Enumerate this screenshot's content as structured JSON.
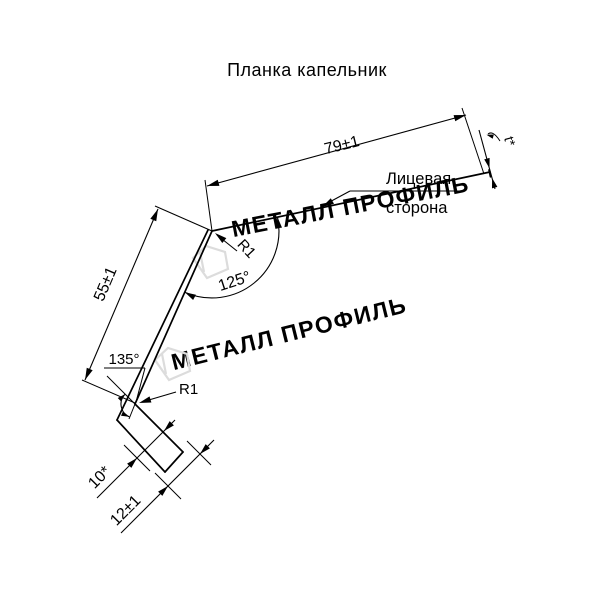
{
  "title": "Планка капельник",
  "watermark": {
    "text": "МЕТАЛЛ ПРОФИЛЬ",
    "color": "#dcdcdc"
  },
  "labels": {
    "dim_top_flange": "79±1",
    "dim_web": "55±1",
    "angle_top": "125°",
    "angle_bottom": "135°",
    "radius_top": "R1",
    "radius_bottom": "R1",
    "dim_hem": "10*",
    "dim_kick": "12±1",
    "thickness": "t*",
    "face_side_line1": "Лицевая",
    "face_side_line2": "сторона"
  },
  "colors": {
    "line": "#000000",
    "text": "#000000",
    "watermark": "#dcdcdc",
    "background": "#ffffff"
  }
}
